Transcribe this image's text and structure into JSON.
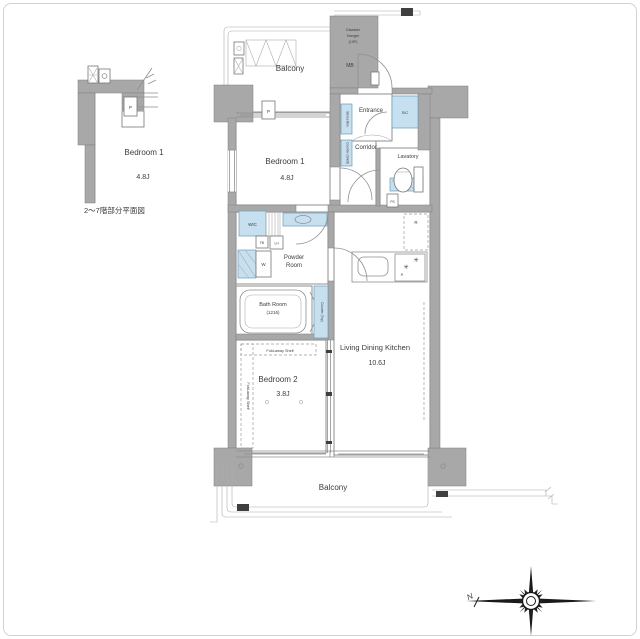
{
  "meta": {
    "caption": "2〜7階部分平面図"
  },
  "inset": {
    "room": "Bedroom 1",
    "size": "4.8J",
    "p": "P"
  },
  "plan": {
    "balcony_top": "Balcony",
    "disaster1": "Disaster",
    "disaster2": "Hanger",
    "disaster3": "(10F)",
    "mb": "MB",
    "p": "P",
    "entrance": "Entrance",
    "sic": "SIC",
    "shoes_box": "Shoes Box",
    "counter_shelf": "Counter (Shelf)",
    "corridor": "Corridor",
    "lavatory": "Lavatory",
    "ps": "PS",
    "fridge": "R",
    "bedroom1": "Bedroom 1",
    "bedroom1_size": "4.8J",
    "wic": "WIC",
    "fb": "FB",
    "lh": "LH",
    "w": "W",
    "powder1": "Powder",
    "powder2": "Room",
    "bath": "Bath Room",
    "bath_size": "(1216)",
    "counter_top": "Counter (Top)",
    "bedroom2": "Bedroom 2",
    "bedroom2_size": "3.8J",
    "shelf_top": "Fold-away Shelf",
    "shelf_side": "Fold-away Shelf",
    "ldk": "Living Dining Kitchen",
    "ldk_size": "10.6J",
    "balcony_bottom": "Balcony",
    "north": "N"
  },
  "colors": {
    "wall": "#a8a8a8",
    "fixture": "#c7e0ef",
    "line": "#8f8f8f",
    "text": "#3c3c3c"
  }
}
